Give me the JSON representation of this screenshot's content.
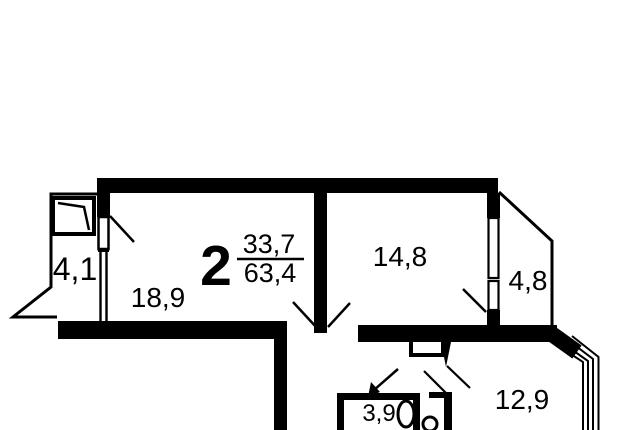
{
  "plan": {
    "background": "#ffffff",
    "ink": "#000000",
    "designation": {
      "rooms_count": "2",
      "living_area": "33,7",
      "total_area": "63,4"
    },
    "labels": {
      "balcony_left": "4,1",
      "living_room": "18,9",
      "room_right": "14,8",
      "balcony_right": "4,8",
      "kitchen": "12,9",
      "bathroom": "3,9"
    }
  }
}
